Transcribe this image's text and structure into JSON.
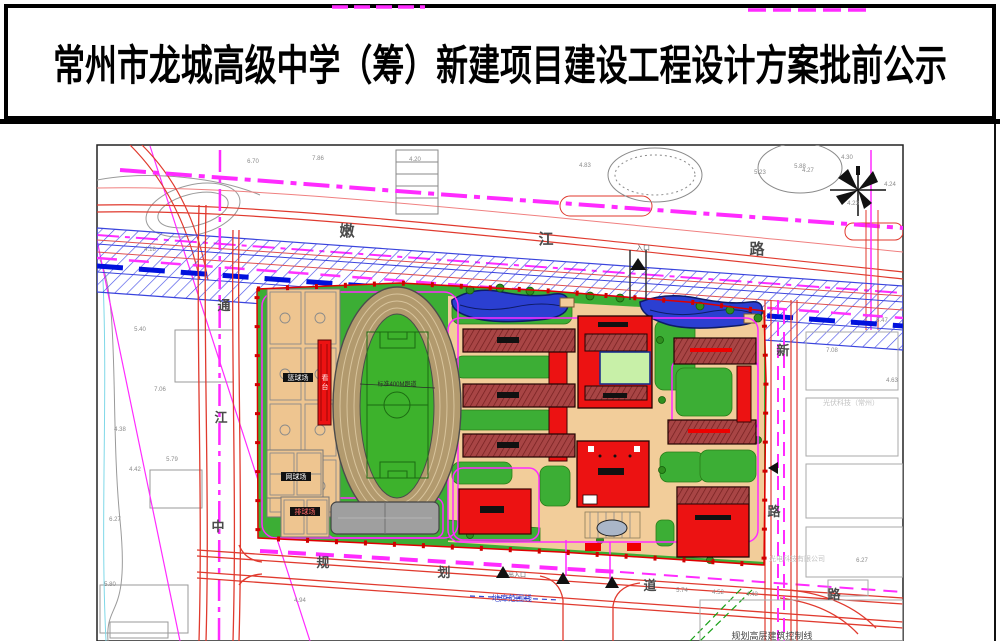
{
  "title": {
    "text": "常州市龙城高级中学（筹）新建项目建设工程设计方案批前公示"
  },
  "colors": {
    "corridor_hatch_blue": "#4a52e8",
    "corridor_dash_blue": "#0011dd",
    "planning_magenta": "#ff2bff",
    "road_red": "#e03a2e",
    "campus_green": "#3cae35",
    "building_bright_red": "#ec1212",
    "building_dark_red": "#a84545",
    "water_blue": "#2b3fd1",
    "plaza_tan": "#f2cd9a"
  },
  "map": {
    "road_labels": [
      {
        "text": "嫩",
        "x": 347,
        "y": 236,
        "size": 15
      },
      {
        "text": "江",
        "x": 546,
        "y": 244,
        "size": 15
      },
      {
        "text": "路",
        "x": 757,
        "y": 254,
        "size": 15
      },
      {
        "text": "通",
        "x": 224,
        "y": 310,
        "size": 13
      },
      {
        "text": "江",
        "x": 221,
        "y": 422,
        "size": 13
      },
      {
        "text": "中",
        "x": 218,
        "y": 531,
        "size": 13
      },
      {
        "text": "规",
        "x": 323,
        "y": 567,
        "size": 13
      },
      {
        "text": "划",
        "x": 444,
        "y": 577,
        "size": 13
      },
      {
        "text": "道",
        "x": 650,
        "y": 590,
        "size": 13
      },
      {
        "text": "路",
        "x": 834,
        "y": 599,
        "size": 13
      },
      {
        "text": "新",
        "x": 783,
        "y": 355,
        "size": 13
      },
      {
        "text": "路",
        "x": 774,
        "y": 516,
        "size": 13
      }
    ],
    "site_labels": [
      {
        "text": "篮球场",
        "x": 298,
        "y": 380,
        "size": 7,
        "color": "#ffffff"
      },
      {
        "text": "网球场",
        "x": 296,
        "y": 479,
        "size": 7,
        "color": "#ffffff"
      },
      {
        "text": "排球场",
        "x": 305,
        "y": 514,
        "size": 7,
        "color": "#ff6666"
      },
      {
        "text": "看",
        "x": 325,
        "y": 380,
        "size": 7,
        "color": "#ffe2e2"
      },
      {
        "text": "台",
        "x": 325,
        "y": 389,
        "size": 7,
        "color": "#ffe2e2"
      },
      {
        "text": "标准400M跑道",
        "x": 397,
        "y": 386,
        "size": 6,
        "color": "#2a2a2a"
      },
      {
        "text": "入口",
        "x": 643,
        "y": 250,
        "size": 7,
        "color": "#666666"
      },
      {
        "text": "出入口",
        "x": 517,
        "y": 577,
        "size": 6,
        "color": "#666666"
      },
      {
        "text": "地库范围线",
        "x": 512,
        "y": 601,
        "size": 8,
        "color": "#3344cc"
      },
      {
        "text": "规划高层建筑控制线",
        "x": 772,
        "y": 639,
        "size": 9,
        "color": "#444444"
      },
      {
        "text": "光伏科技（常州）",
        "x": 851,
        "y": 405,
        "size": 7,
        "color": "#c2c2c2"
      },
      {
        "text": "光电科技有限公司",
        "x": 797,
        "y": 561,
        "size": 7,
        "color": "#c2c2c2"
      }
    ],
    "spot_elevations": [
      {
        "v": "4.27",
        "x": 808,
        "y": 172
      },
      {
        "v": "4.30",
        "x": 847,
        "y": 159
      },
      {
        "v": "4.24",
        "x": 890,
        "y": 186
      },
      {
        "v": "4.23",
        "x": 853,
        "y": 205
      },
      {
        "v": "6.70",
        "x": 253,
        "y": 163
      },
      {
        "v": "4.20",
        "x": 415,
        "y": 161
      },
      {
        "v": "4.83",
        "x": 585,
        "y": 167
      },
      {
        "v": "5.23",
        "x": 760,
        "y": 174
      },
      {
        "v": "5.88",
        "x": 800,
        "y": 168
      },
      {
        "v": "4.18",
        "x": 150,
        "y": 251
      },
      {
        "v": "5.40",
        "x": 140,
        "y": 331
      },
      {
        "v": "7.06",
        "x": 160,
        "y": 391
      },
      {
        "v": "4.38",
        "x": 120,
        "y": 431
      },
      {
        "v": "5.79",
        "x": 172,
        "y": 461
      },
      {
        "v": "4.42",
        "x": 135,
        "y": 471
      },
      {
        "v": "6.27",
        "x": 115,
        "y": 521
      },
      {
        "v": "5.80",
        "x": 110,
        "y": 586
      },
      {
        "v": "4.94",
        "x": 300,
        "y": 602
      },
      {
        "v": "5.74",
        "x": 682,
        "y": 592
      },
      {
        "v": "4.52",
        "x": 718,
        "y": 594
      },
      {
        "v": "4.43",
        "x": 752,
        "y": 596
      },
      {
        "v": "6.27",
        "x": 862,
        "y": 562
      },
      {
        "v": "5.47",
        "x": 882,
        "y": 322
      },
      {
        "v": "4.63",
        "x": 892,
        "y": 382
      },
      {
        "v": "7.08",
        "x": 832,
        "y": 352
      },
      {
        "v": "7.86",
        "x": 318,
        "y": 160
      }
    ]
  }
}
